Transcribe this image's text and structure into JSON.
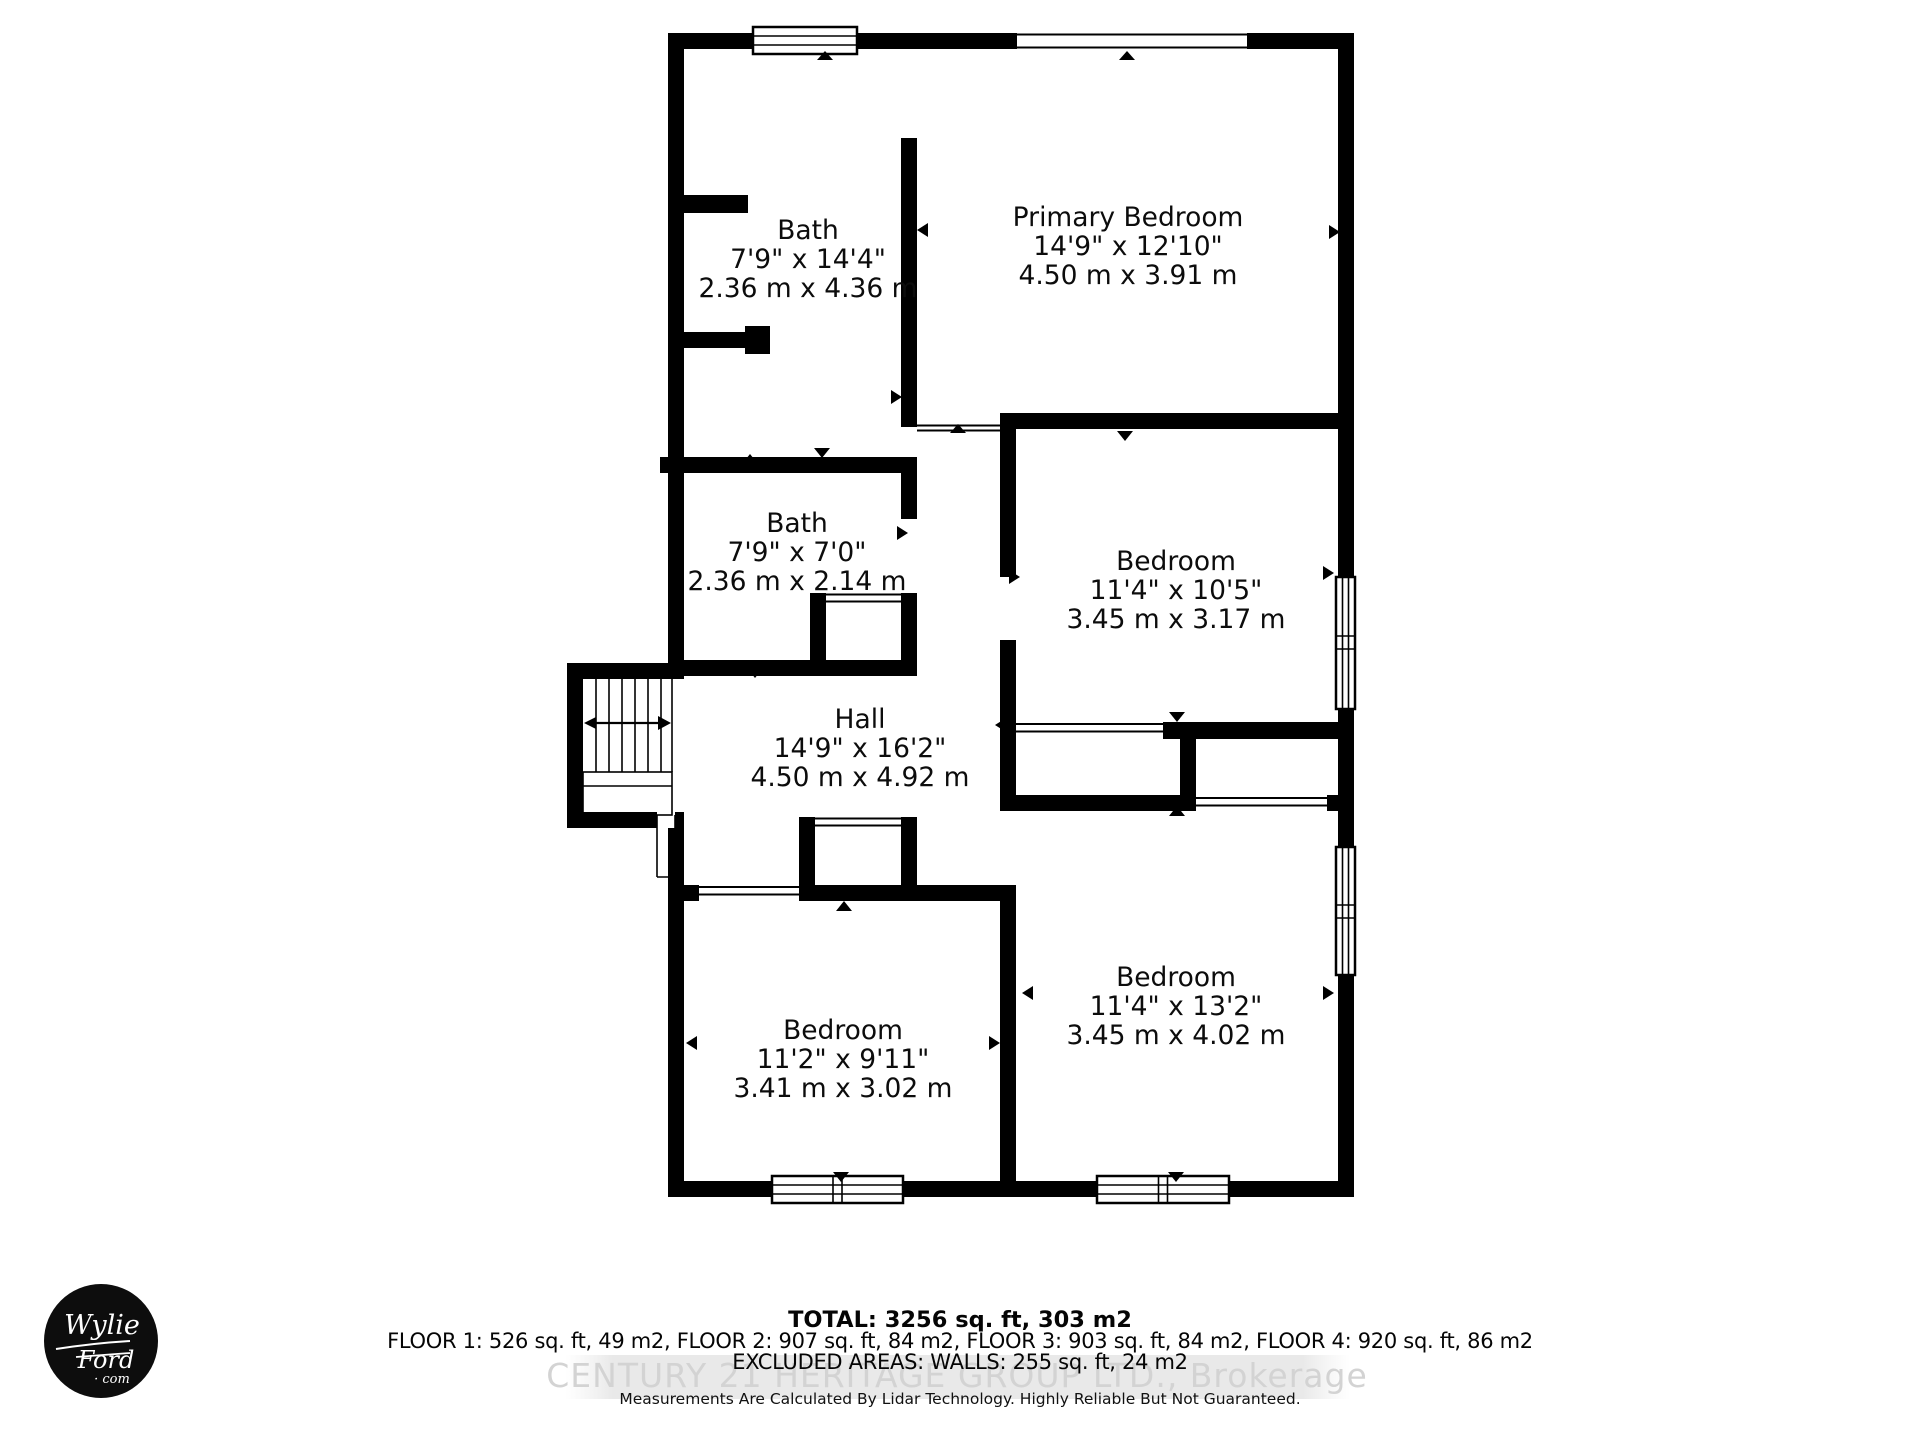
{
  "rooms": {
    "bath_ensuite": {
      "name": "Bath",
      "imperial": "7'9\" x 14'4\"",
      "metric": "2.36 m x 4.36 m"
    },
    "primary_bedroom": {
      "name": "Primary Bedroom",
      "imperial": "14'9\" x 12'10\"",
      "metric": "4.50 m x 3.91 m"
    },
    "bath_main": {
      "name": "Bath",
      "imperial": "7'9\" x 7'0\"",
      "metric": "2.36 m x 2.14 m"
    },
    "bedroom_middle": {
      "name": "Bedroom",
      "imperial": "11'4\" x 10'5\"",
      "metric": "3.45 m x 3.17 m"
    },
    "hall": {
      "name": "Hall",
      "imperial": "14'9\" x 16'2\"",
      "metric": "4.50 m x 4.92 m"
    },
    "bedroom_bottom_left": {
      "name": "Bedroom",
      "imperial": "11'2\" x 9'11\"",
      "metric": "3.41 m x 3.02 m"
    },
    "bedroom_bottom_right": {
      "name": "Bedroom",
      "imperial": "11'4\" x 13'2\"",
      "metric": "3.45 m x 4.02 m"
    }
  },
  "summary": {
    "total": "TOTAL: 3256 sq. ft, 303 m2",
    "floors": "FLOOR 1: 526 sq. ft, 49 m2, FLOOR 2: 907 sq. ft, 84 m2, FLOOR 3: 903 sq. ft, 84 m2, FLOOR 4: 920 sq. ft, 86 m2",
    "excluded": "EXCLUDED AREAS: WALLS: 255 sq. ft, 24 m2",
    "disclaimer": "Measurements Are Calculated By Lidar Technology. Highly Reliable But Not Guaranteed."
  },
  "watermark": {
    "text": "CENTURY 21 HERITAGE GROUP LTD., Brokerage"
  },
  "logo": {
    "line1": "Wylie",
    "line2": "Ford",
    "line3": "· com"
  },
  "colors": {
    "wall": "#000000",
    "background": "#ffffff",
    "watermark_text": "#d3d3d3",
    "watermark_band": "#e9e9e9",
    "logo_circle": "#0d0d0d"
  }
}
